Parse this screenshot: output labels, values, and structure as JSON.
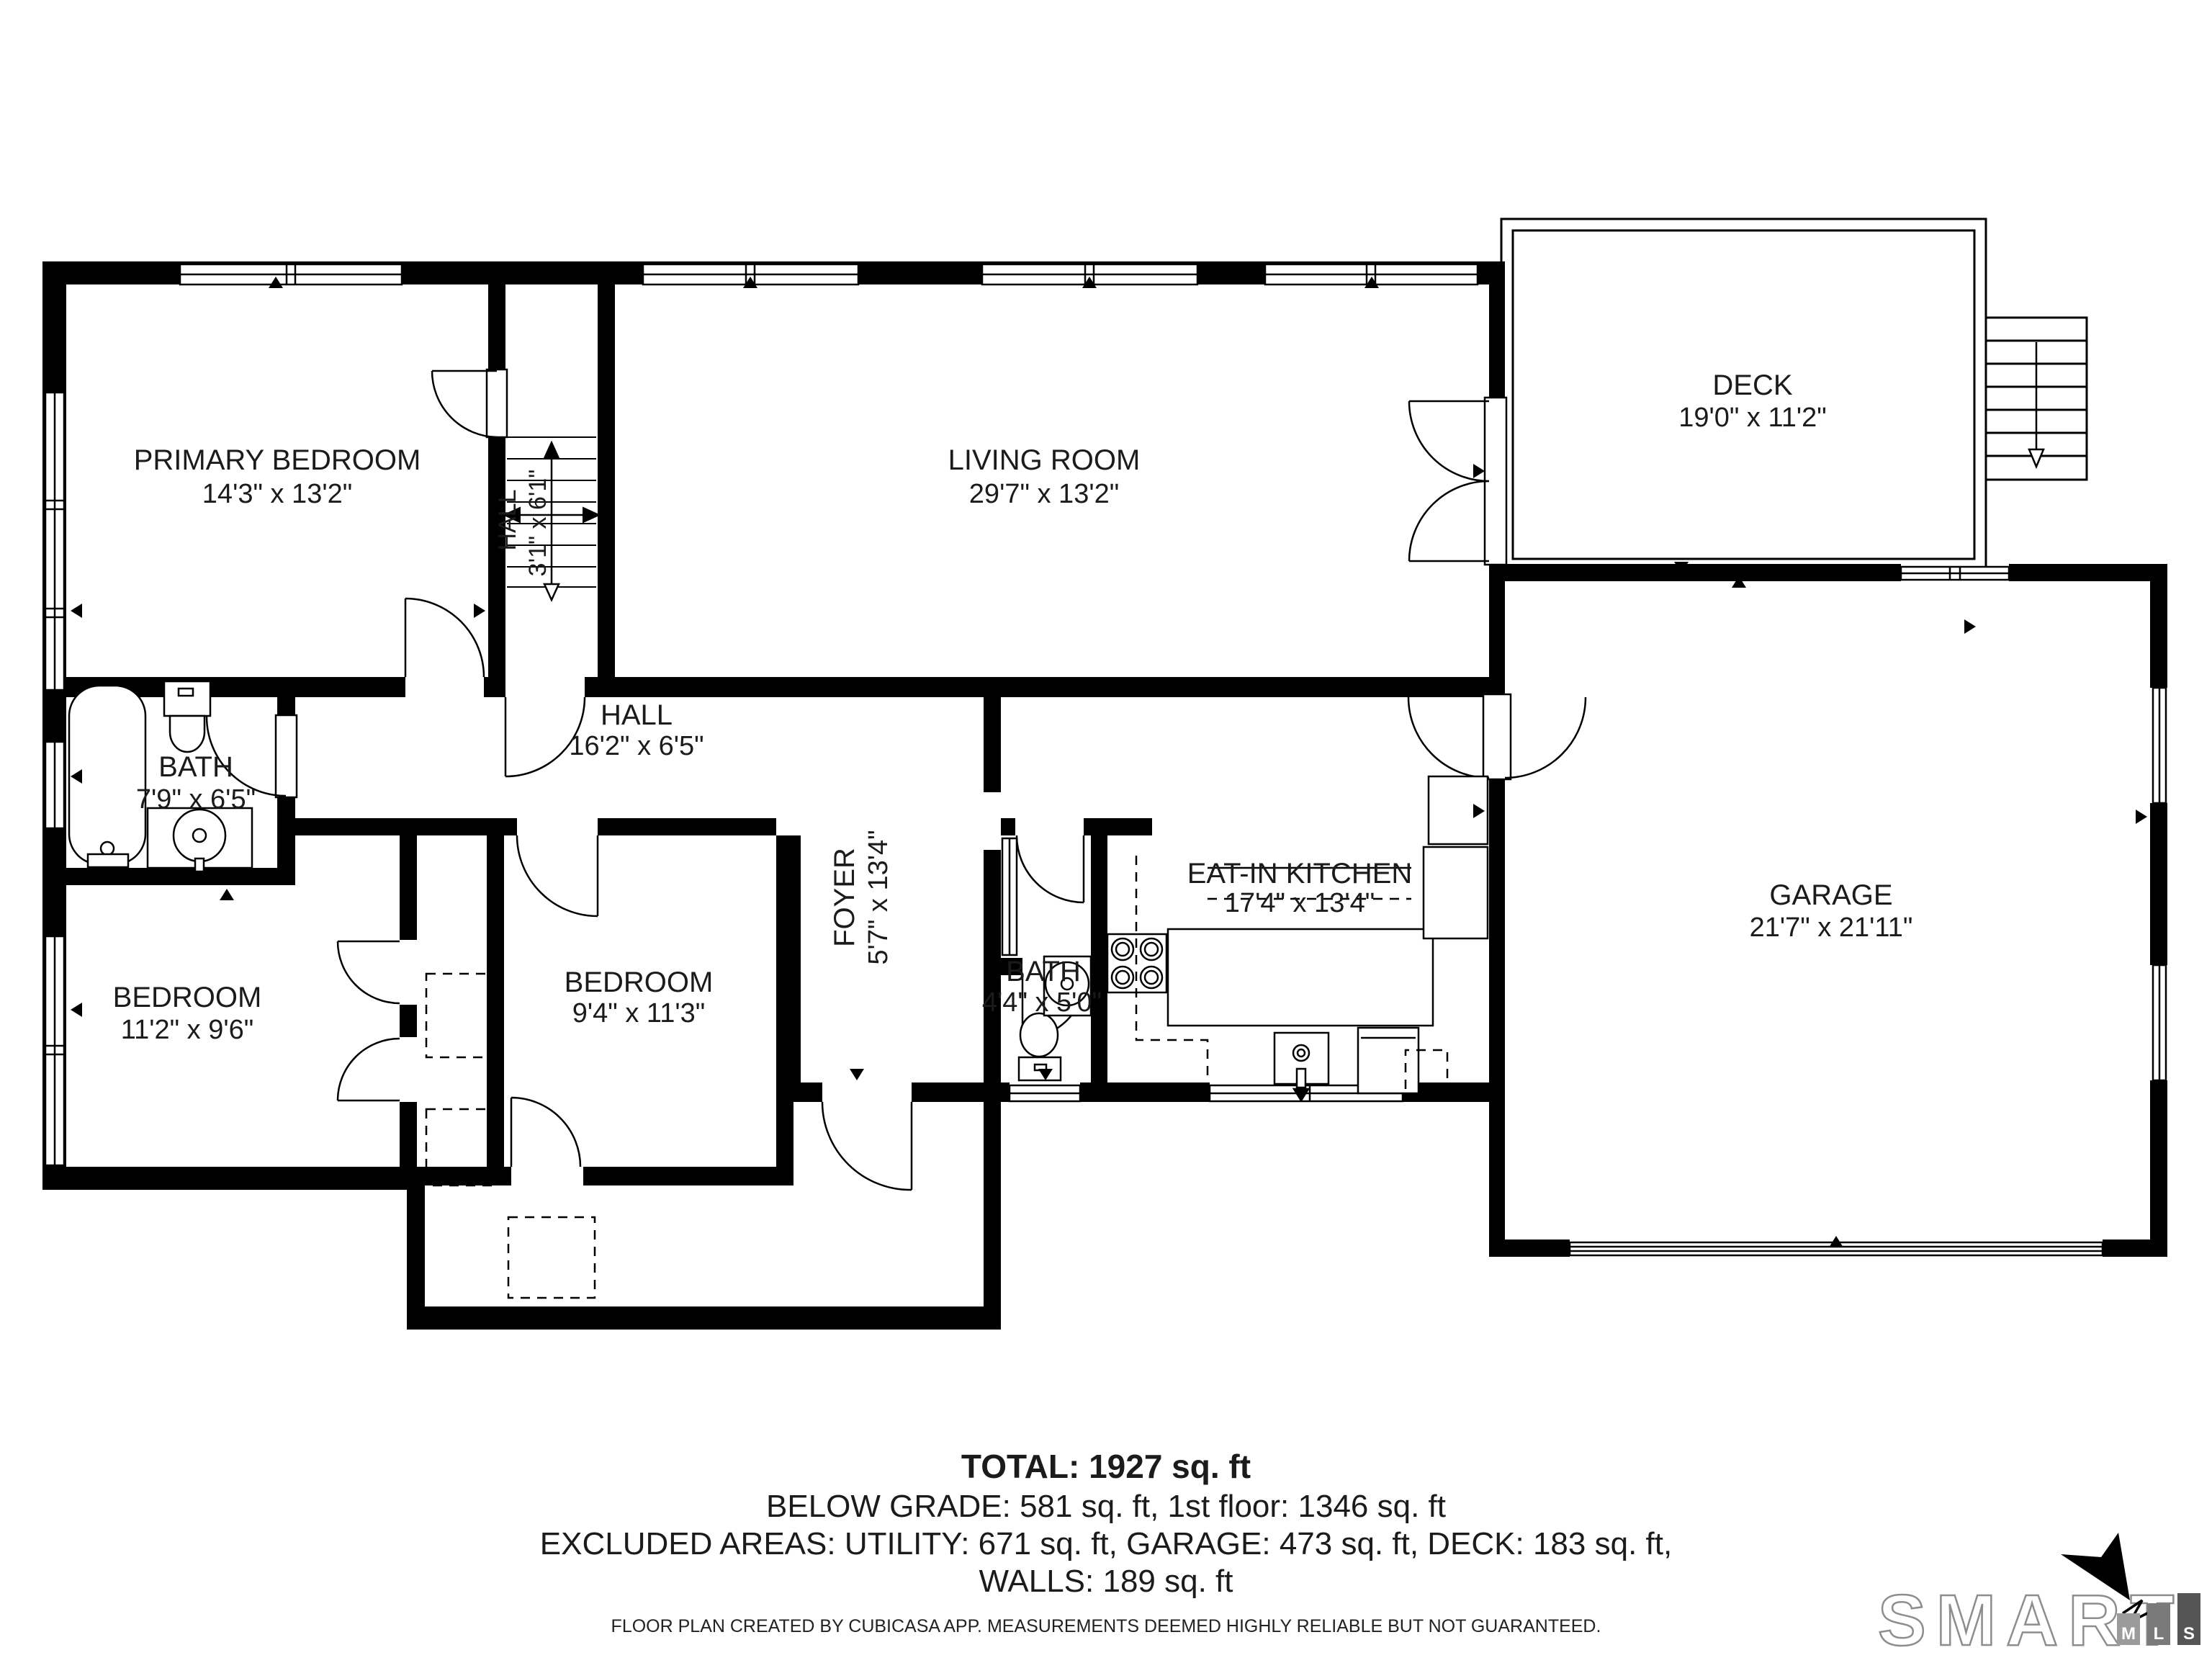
{
  "rooms": {
    "primary_bedroom": {
      "name": "PRIMARY BEDROOM",
      "dims": "14'3\" x 13'2\""
    },
    "living_room": {
      "name": "LIVING ROOM",
      "dims": "29'7\" x 13'2\""
    },
    "deck": {
      "name": "DECK",
      "dims": "19'0\" x 11'2\""
    },
    "stair_hall": {
      "name": "HALL",
      "dims": "3'1\" x 6'1\""
    },
    "hall": {
      "name": "HALL",
      "dims": "16'2\" x 6'5\""
    },
    "bath": {
      "name": "BATH",
      "dims": "7'9\" x 6'5\""
    },
    "bedroom_left": {
      "name": "BEDROOM",
      "dims": "11'2\" x 9'6\""
    },
    "bedroom_center": {
      "name": "BEDROOM",
      "dims": "9'4\" x 11'3\""
    },
    "foyer": {
      "name": "FOYER",
      "dims": "5'7\" x 13'4\""
    },
    "bath_small": {
      "name": "BATH",
      "dims": "4'4\" x 5'0\""
    },
    "kitchen": {
      "name": "EAT-IN KITCHEN",
      "dims": "17'4\" x 13'4\""
    },
    "garage": {
      "name": "GARAGE",
      "dims": "21'7\" x 21'11\""
    }
  },
  "summary": {
    "total": "TOTAL: 1927 sq. ft",
    "below_grade": "BELOW GRADE: 581 sq. ft, 1st floor: 1346 sq. ft",
    "excluded": "EXCLUDED AREAS: UTILITY: 671 sq. ft, GARAGE: 473 sq. ft, DECK: 183 sq. ft,",
    "walls": "WALLS: 189 sq. ft"
  },
  "footer": {
    "disclaimer": "FLOOR PLAN CREATED BY CUBICASA APP. MEASUREMENTS DEEMED HIGHLY RELIABLE BUT NOT GUARANTEED."
  },
  "logo": {
    "word": "SMART",
    "m": "M",
    "l": "L",
    "s": "S"
  },
  "colors": {
    "wall": "#000000",
    "text": "#1b1b1b",
    "logo_gray": "#8d8d8d"
  }
}
